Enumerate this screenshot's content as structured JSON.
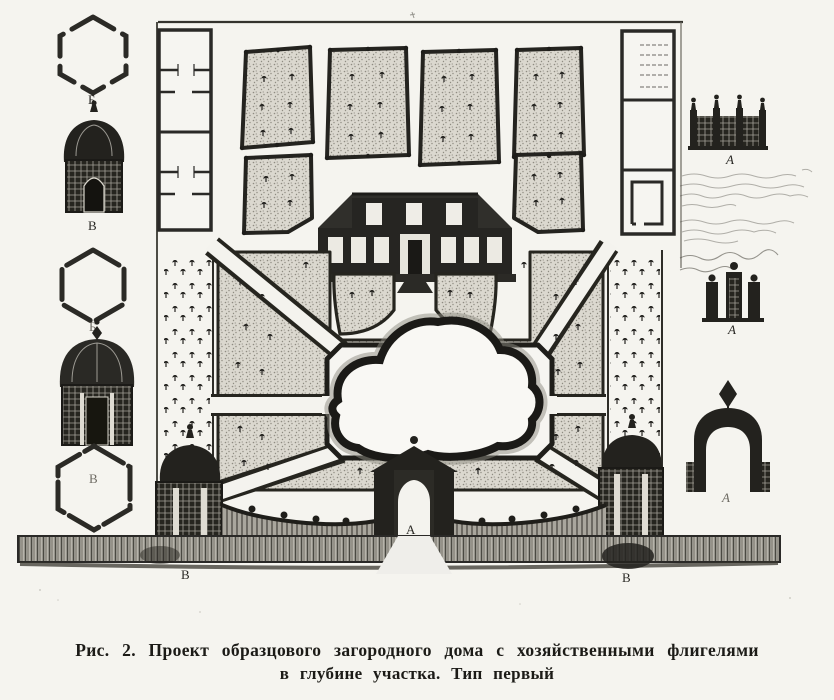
{
  "figure": {
    "caption": {
      "line1": "Рис. 2. Проект образцового загородного дома с хозяйственными флигелями",
      "line2": "в глубине участка. Тип первый"
    },
    "labels": {
      "hex1": "Б",
      "pav1": "В",
      "hex2": "Б",
      "hex3": "В",
      "fence_elevation": "А",
      "gate_elevation": "А",
      "arch_elevation": "А",
      "center_gate": "А",
      "wall_left": "В",
      "wall_right": "В"
    },
    "colors": {
      "ink": "#23221f",
      "paper": "#f5f4ef",
      "bed_fill": "#dbd8cf"
    }
  }
}
